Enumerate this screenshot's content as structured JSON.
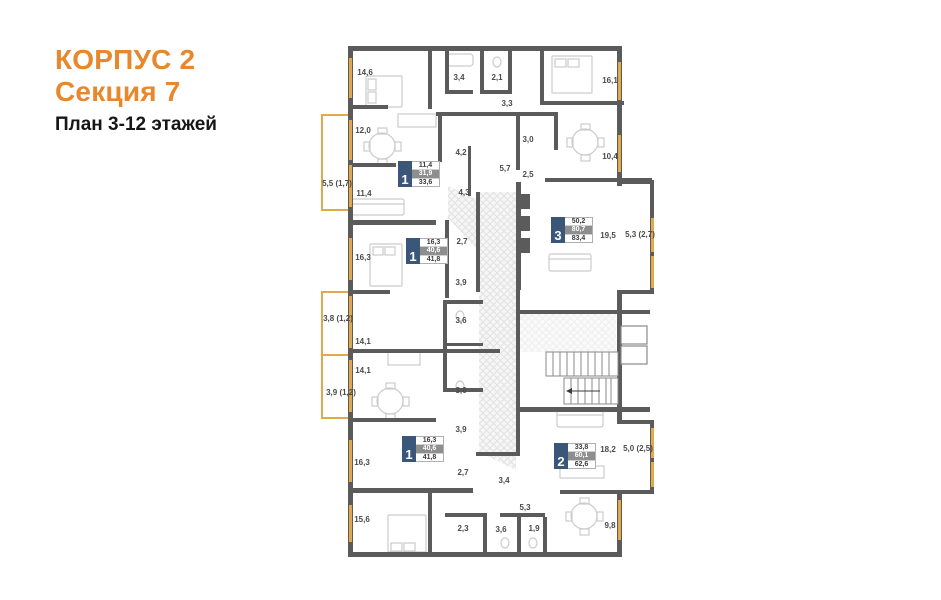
{
  "title": {
    "building": "КОРПУС 2",
    "section": "Секция 7",
    "floors": "План 3-12 этажей"
  },
  "colors": {
    "accent_orange": "#E8872B",
    "wall_gray": "#5B5B5B",
    "window_yellow": "#E2A94C",
    "badge_blue": "#3A5679",
    "badge_gray_row": "#8E8E8E"
  },
  "apartments": [
    {
      "rooms": "1",
      "area_living": "11,4",
      "area_main": "31,9",
      "area_total": "33,6"
    },
    {
      "rooms": "1",
      "area_living": "16,3",
      "area_main": "40,6",
      "area_total": "41,8"
    },
    {
      "rooms": "3",
      "area_living": "50,2",
      "area_main": "80,7",
      "area_total": "83,4"
    },
    {
      "rooms": "2",
      "area_living": "33,8",
      "area_main": "60,1",
      "area_total": "62,6"
    },
    {
      "rooms": "1",
      "area_living": "16,3",
      "area_main": "40,6",
      "area_total": "41,8"
    }
  ],
  "room_labels": [
    "14,6",
    "3,4",
    "2,1",
    "16,1",
    "3,3",
    "12,0",
    "4,2",
    "3,0",
    "10,4",
    "5,7",
    "2,5",
    "5,5 (1,7)",
    "11,4",
    "4,3",
    "16,3",
    "2,7",
    "19,5",
    "5,3 (2,7)",
    "3,9",
    "3,8 (1,2)",
    "14,1",
    "3,6",
    "14,1",
    "3,9 (1,2)",
    "3,6",
    "3,9",
    "16,3",
    "2,7",
    "18,2",
    "5,0 (2,5)",
    "3,4",
    "5,3",
    "15,6",
    "2,3",
    "3,6",
    "1,9",
    "9,8"
  ]
}
